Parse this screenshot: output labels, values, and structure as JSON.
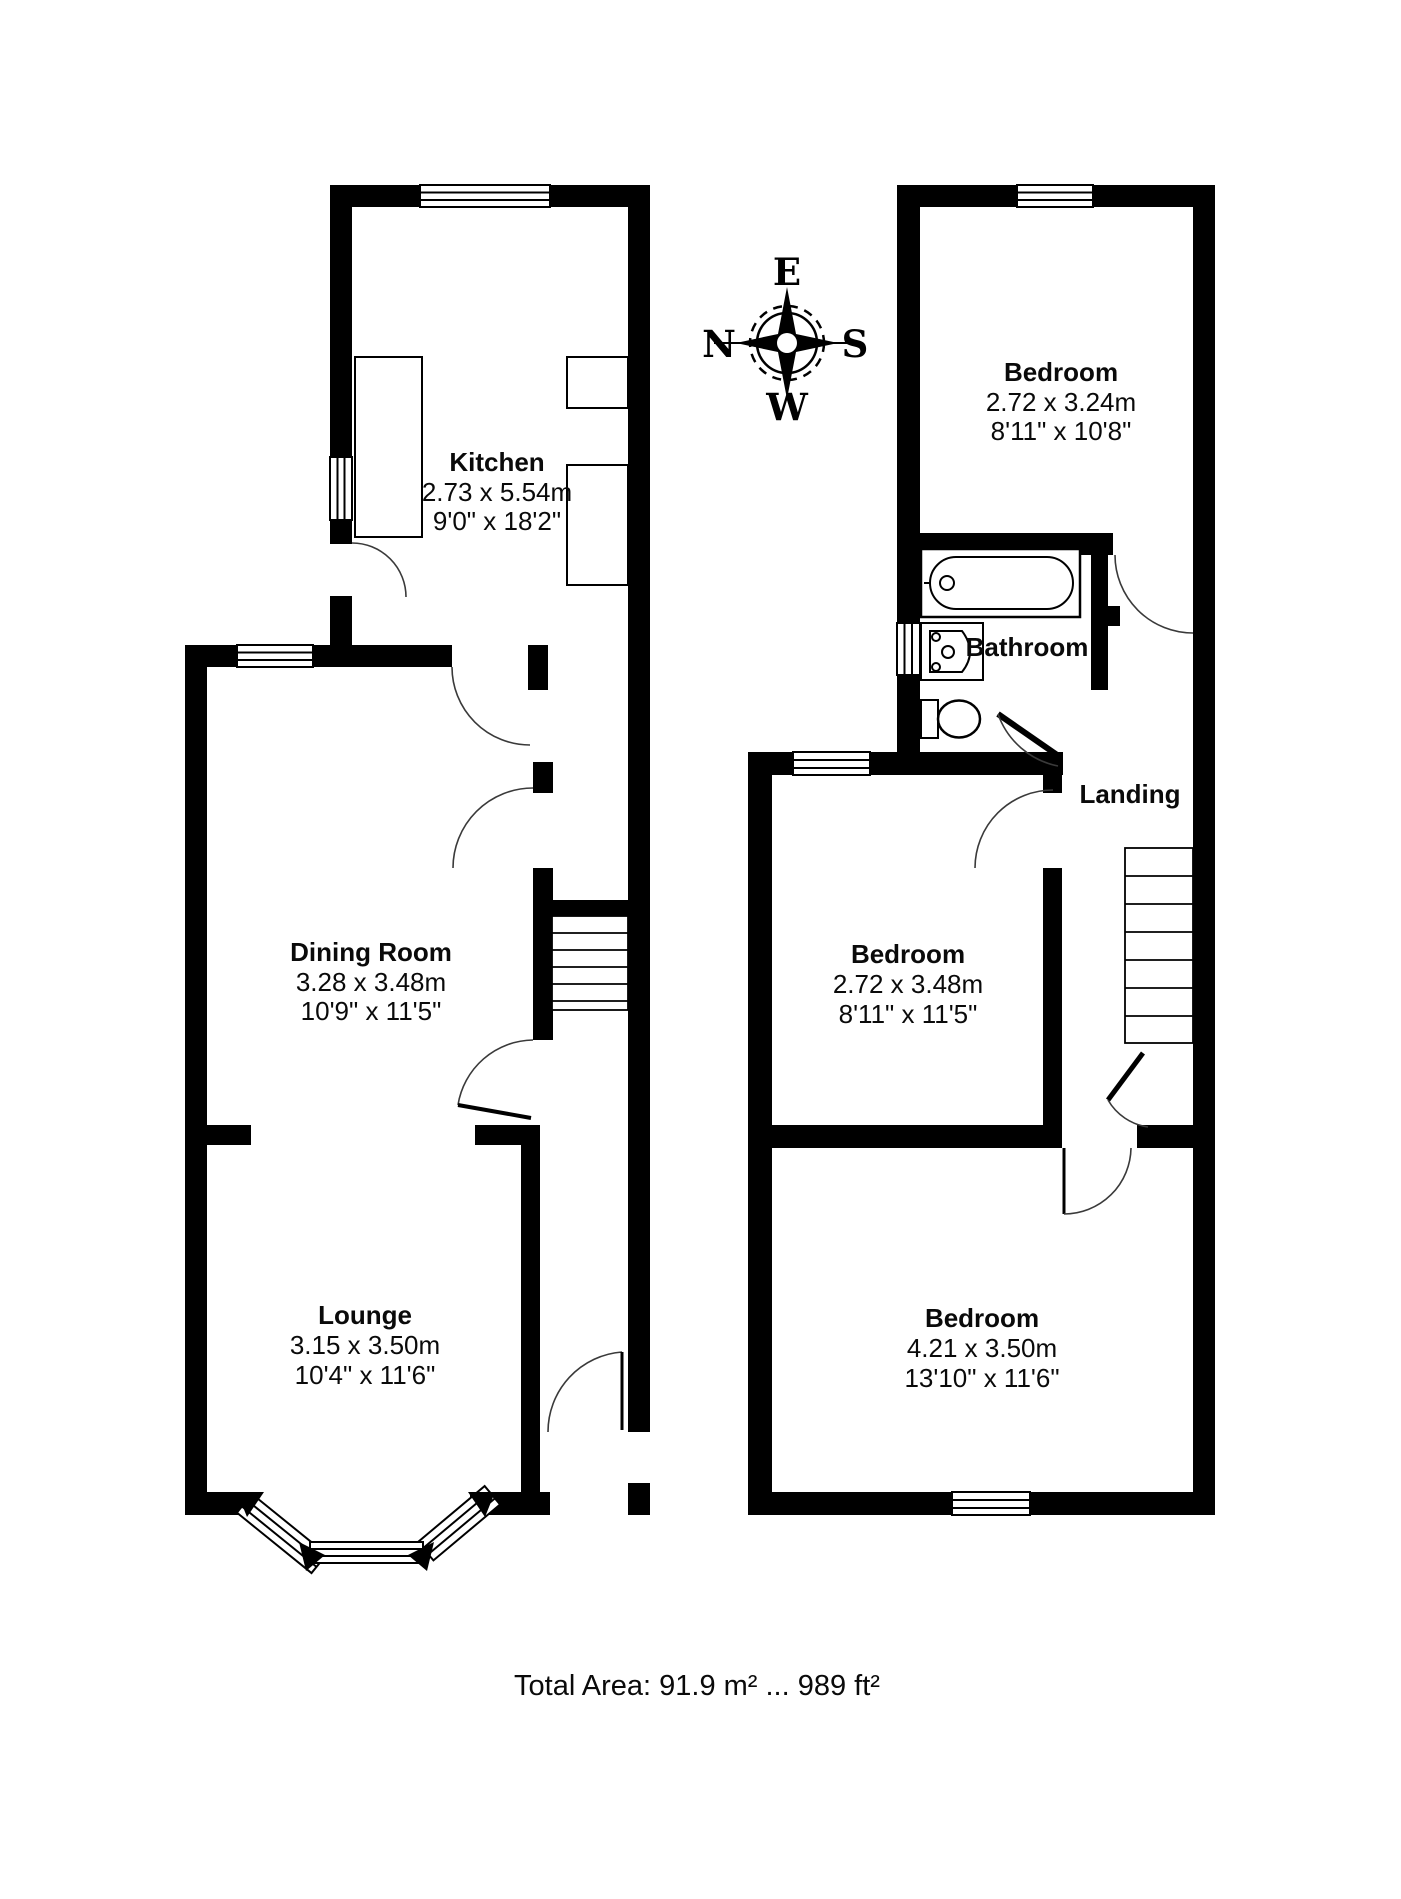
{
  "floorplan": {
    "total_area": "Total Area: 91.9 m² ... 989 ft²",
    "compass": {
      "n": "N",
      "e": "E",
      "s": "S",
      "w": "W"
    },
    "ground_floor": {
      "rooms": [
        {
          "name": "Kitchen",
          "metric": "2.73 x 5.54m",
          "imperial": "9'0\" x 18'2\""
        },
        {
          "name": "Dining Room",
          "metric": "3.28 x 3.48m",
          "imperial": "10'9\" x 11'5\""
        },
        {
          "name": "Lounge",
          "metric": "3.15 x 3.50m",
          "imperial": "10'4\" x 11'6\""
        }
      ]
    },
    "first_floor": {
      "rooms": [
        {
          "name": "Bedroom",
          "metric": "2.72 x 3.24m",
          "imperial": "8'11\" x 10'8\""
        },
        {
          "name": "Bathroom"
        },
        {
          "name": "Landing"
        },
        {
          "name": "Bedroom",
          "metric": "2.72 x 3.48m",
          "imperial": "8'11\" x 11'5\""
        },
        {
          "name": "Bedroom",
          "metric": "4.21 x 3.50m",
          "imperial": "13'10\" x 11'6\""
        }
      ]
    },
    "colors": {
      "wall": "#000000",
      "background": "#ffffff",
      "door_arc": "#3a3a3a"
    }
  }
}
